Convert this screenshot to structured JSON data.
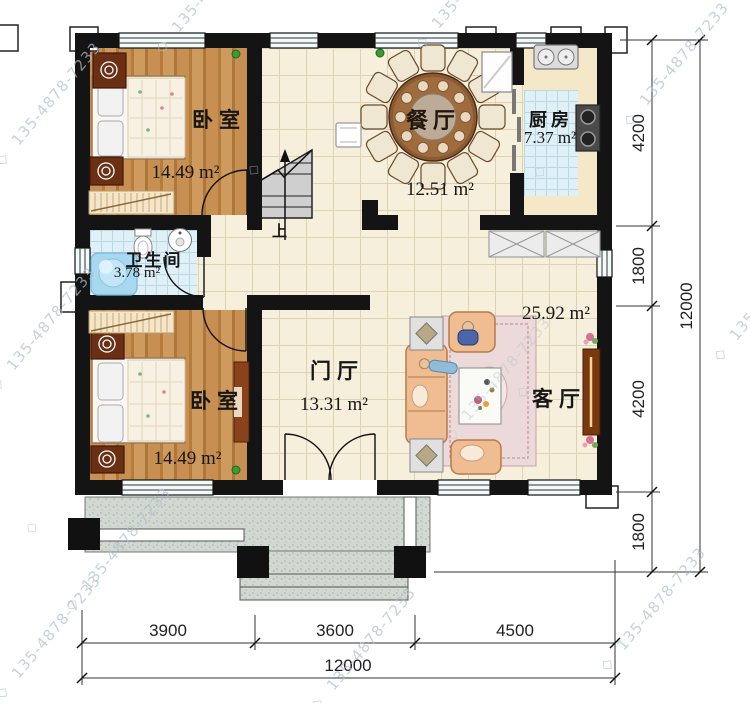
{
  "rooms": [
    {
      "key": "bedroom-top",
      "name": "卧室",
      "area": "14.49 m²"
    },
    {
      "key": "dining",
      "name": "餐厅",
      "area": "12.51 m²"
    },
    {
      "key": "kitchen",
      "name": "厨房",
      "area": "7.37 m²"
    },
    {
      "key": "bathroom",
      "name": "卫生间",
      "area": "3.78 m²"
    },
    {
      "key": "bedroom-bottom",
      "name": "卧室",
      "area": "14.49 m²"
    },
    {
      "key": "foyer",
      "name": "门厅",
      "area": "13.31 m²"
    },
    {
      "key": "living",
      "name": "客厅",
      "area": "25.92 m²"
    }
  ],
  "stairs": {
    "up_label": "上"
  },
  "dimensions": {
    "right_segments": [
      "4200",
      "1800",
      "4200",
      "1800"
    ],
    "right_total": "12000",
    "bottom_segments": [
      "3900",
      "3600",
      "4500"
    ],
    "bottom_total": "12000"
  },
  "watermark": {
    "symbol": "◇",
    "phone": "135-4878-7233"
  },
  "colors": {
    "wall": "#141414",
    "wood": "#c08a4e",
    "tile_cream": "#f5efdb",
    "tile_blue": "#e0f0f7",
    "terrace": "#d2d8d2",
    "sofa": "#f0bc92",
    "watermark": "#aebfcd"
  }
}
